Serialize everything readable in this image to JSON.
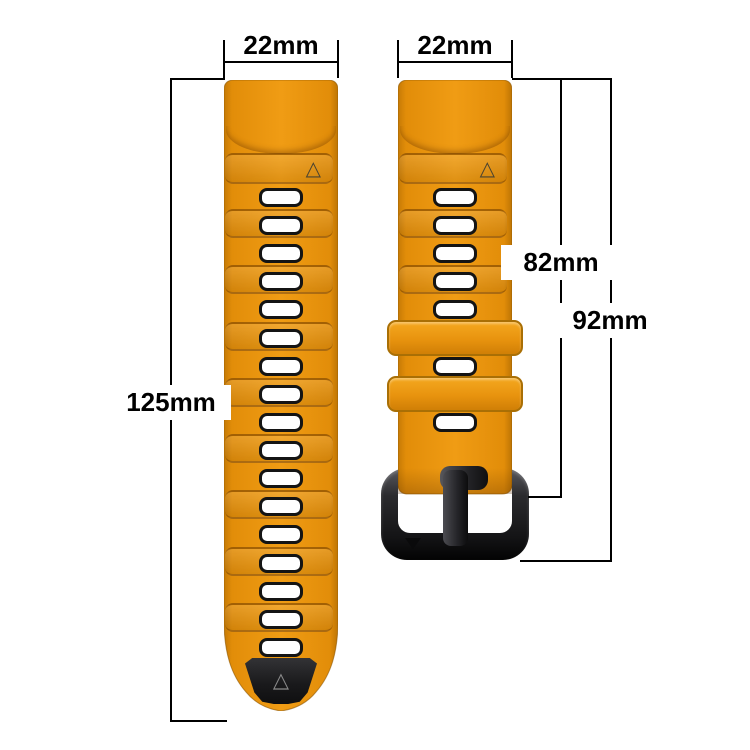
{
  "title": "Watch band size diagram",
  "background": "#ffffff",
  "colors": {
    "strap_orange": "#e8930e",
    "strap_orange_light": "#f3a318",
    "strap_orange_dark": "#c07704",
    "band_seam": "#784200",
    "hole_fill": "#ffffff",
    "hole_border": "#141414",
    "black_hardware": "#1a1a1c",
    "dimension_line": "#000000",
    "label_text": "#000000"
  },
  "labels": {
    "left_strap_width": "22mm",
    "right_strap_width": "22mm",
    "left_strap_length": "125mm",
    "strap_to_buckle_length": "82mm",
    "total_length": "92mm"
  },
  "icons": {
    "alignment_triangle": "△",
    "tip_triangle": "△",
    "buckle_marker_triangle": "▼"
  },
  "left_strap": {
    "description": "long holes strap with black inner tip",
    "hole_count": 17,
    "ridge_band_count": 8,
    "has_triangle_band": true,
    "has_black_tip": true
  },
  "right_strap": {
    "description": "short buckle strap",
    "hole_count": 7,
    "keeper_count": 2,
    "has_triangle_band": true,
    "has_buckle": true
  }
}
